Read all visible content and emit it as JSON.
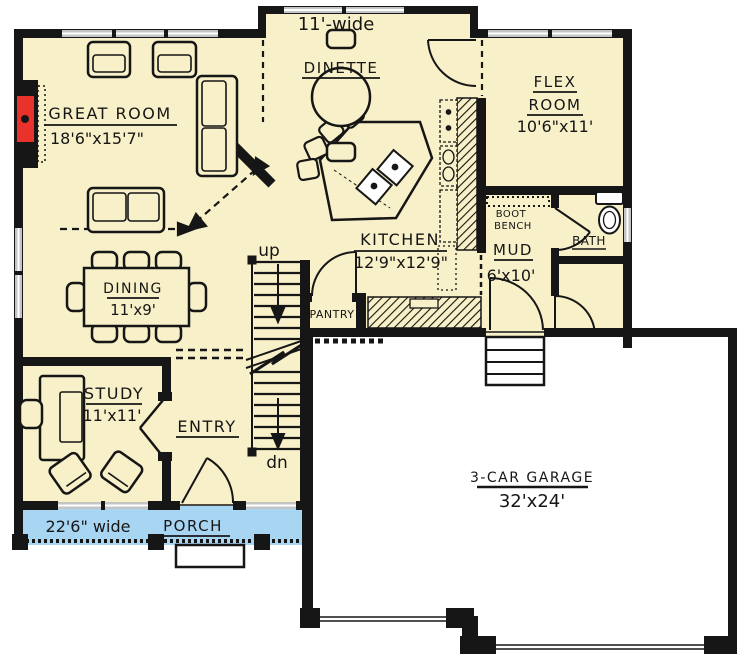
{
  "plan": {
    "labels": {
      "dinette_width": "11'-wide",
      "dinette": "DINETTE",
      "flex_line1": "FLEX",
      "flex_line2": "ROOM",
      "flex_dims": "10'6\"x11'",
      "great_room": "GREAT ROOM",
      "great_room_dims": "18'6\"x15'7\"",
      "kitchen": "KITCHEN",
      "kitchen_dims": "12'9\"x12'9\"",
      "dining": "DINING",
      "dining_dims": "11'x9'",
      "pantry": "PANTRY",
      "boot_line1": "BOOT",
      "boot_line2": "BENCH",
      "mud": "MUD",
      "mud_dims": "6'x10'",
      "bath": "BATH",
      "study": "STUDY",
      "study_dims": "11'x11'",
      "entry": "ENTRY",
      "stairs_up": "up",
      "stairs_down": "dn",
      "porch": "PORCH",
      "porch_width": "22'6\" wide",
      "garage": "3-CAR GARAGE",
      "garage_dims": "32'x24'"
    },
    "colors": {
      "floor": "#f7f0c8",
      "porch": "#a8d5f2",
      "wall": "#161616",
      "window": "#c4c4c4",
      "fireplace_red": "#e8322b",
      "garage_floor": "#ffffff"
    }
  }
}
